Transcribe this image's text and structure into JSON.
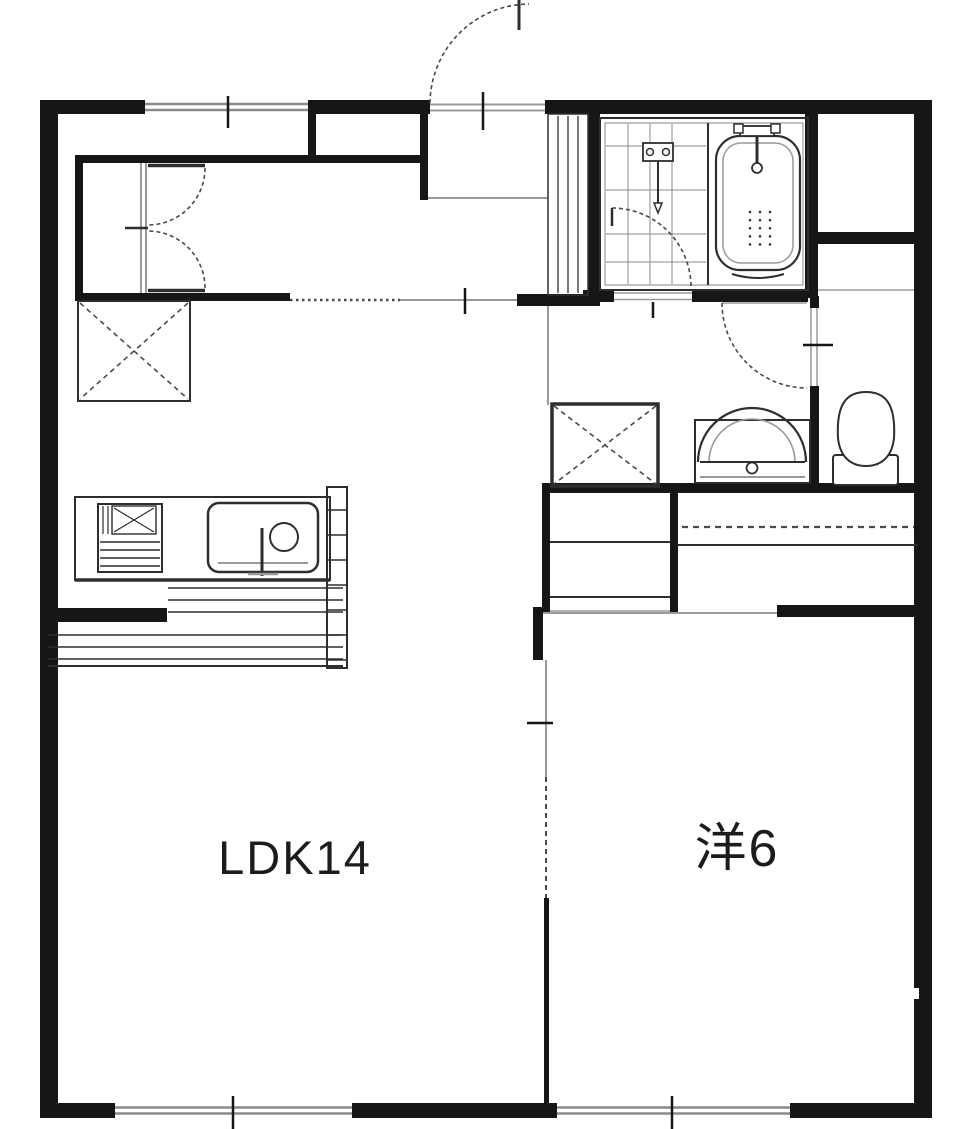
{
  "meta": {
    "type": "floor-plan"
  },
  "rooms": {
    "ldk": {
      "label": "LDK14"
    },
    "western": {
      "label": "洋6"
    }
  },
  "fixtures": {
    "entrance": "entrance-door",
    "shoe_cabinet": "shoe-cabinet",
    "closet": "double-door-closet",
    "refrigerator": "refrigerator-space",
    "stove": "gas-stove",
    "sink": "kitchen-sink",
    "counter": "kitchen-counter",
    "bathtub": "bathtub",
    "shower": "shower-mixer",
    "bath_door": "bathroom-door",
    "washing_machine": "washing-machine-space",
    "washbasin": "washbasin",
    "toilet": "toilet",
    "toilet_door": "toilet-door",
    "bedroom_closet": "bedroom-closet",
    "partition": "sliding-partition",
    "windows": [
      "top-window",
      "ldk-window",
      "bedroom-window"
    ]
  },
  "colors": {
    "wall": "#161616",
    "line": "#2e2e2e",
    "opening": "#9a9a9a",
    "dash": "#4a4a4a",
    "grid": "#8a8a8a",
    "text": "#1c1c1c",
    "bg": "#ffffff"
  }
}
